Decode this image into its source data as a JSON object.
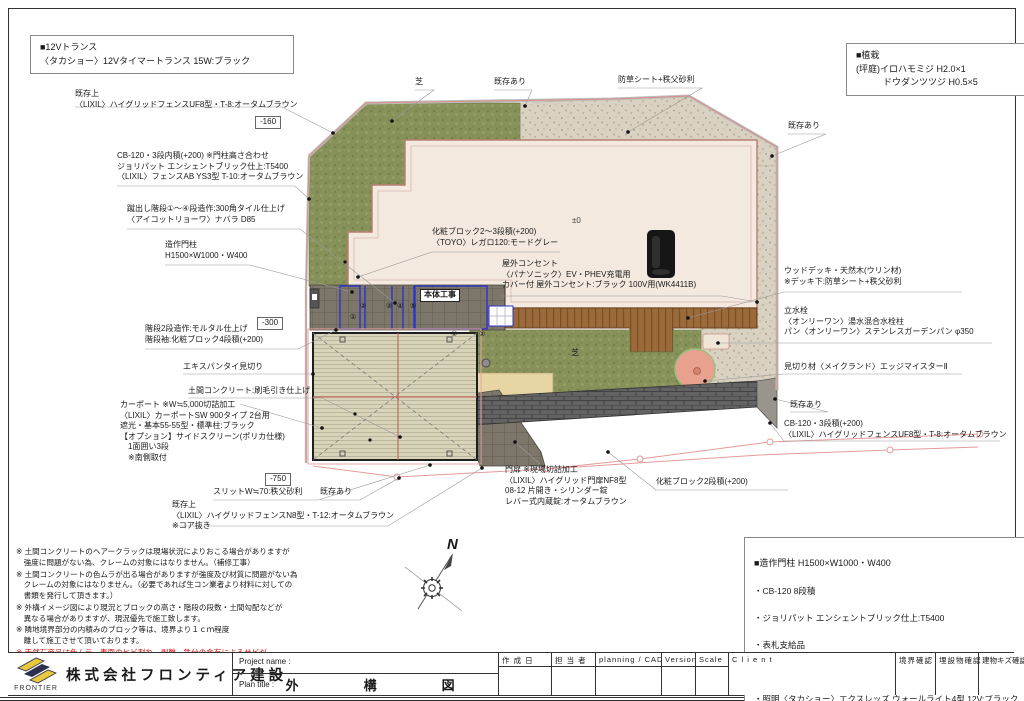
{
  "colors": {
    "boundary_pink": "#e59a9a",
    "lawn_green": "#87925a",
    "gravel_beige": "#d9d2c2",
    "house_fill": "#f3e9de",
    "deck_brown": "#9b6a3a",
    "blue_outline": "#2b35c8",
    "note_warning_red": "#cc1111",
    "logo_yellow": "#e6c93c",
    "logo_navy": "#2e2e4e"
  },
  "boxes": {
    "transformer": {
      "text": "■12Vトランス\n〈タカショー〉12Vタイマートランス 15W:ブラック"
    },
    "planting": {
      "text": "■植栽\n(坪庭)イロハモミジ H2.0×1\n　　　ドウダンツツジ H0.5×5"
    },
    "gate_pillar": {
      "title": "■造作門柱 H1500×W1000・W400",
      "items": [
        "・CB-120 8段積",
        "・ジョリパット エンシェントブリック仕上:T5400",
        "・表札支給品",
        "・ポスト〈LIXIL〉エクスポスト口金タイプ N-1型 1B-05:ブラック",
        "・照明〈タカショー〉エクスレッズ ウォールライト4型 12V:ブラック"
      ]
    }
  },
  "labels": {
    "fence_uf8_top": "既存上\n〈LIXIL〉ハイグリッドフェンスUF8型・T-8:オータムブラウン",
    "level_160": "-160",
    "cb120_fence_ab": "CB-120・3段内積(+200) ※門柱高さ合わせ\nジョリパット エンシェントブリック仕上:T5400\n〈LIXIL〉フェンスAB YS3型 T-10:オータムブラウン",
    "kedashi_stairs": "蹴出し階段①～④段造作:300角タイル仕上げ\n〈アイコットリョーワ〉ナバラ D85",
    "gate_pillar": "造作門柱\nH1500×W1000・W400",
    "level_300": "-300",
    "stairs2": "階段2段造作:モルタル仕上げ\n階段袖:化粧ブロック4段積(+200)",
    "expantie": "エキスパンタイ見切り",
    "doma_concrete": "土間コンクリート:刷毛引き仕上げ",
    "carport": "カーポート ※W≒5,000切詰加工\n〈LIXIL〉カーポートSW 900タイプ 2台用\n遮光・基本55-55型・標準柱:ブラック\n【オプション】サイドスクリーン(ポリカ仕様)\n　1面囲い3段\n　※南側取付",
    "level_750": "-750",
    "slit": "スリットW≒70:秩父砂利",
    "existing_bl": "既存あり",
    "fence_n8": "既存上\n〈LIXIL〉ハイグリッドフェンスN8型・T-12:オータムブラウン\n※コア抜き",
    "shiba_top": "芝",
    "existing_top": "既存あり",
    "weed_sheet": "防草シート+秩父砂利",
    "existing_tr": "既存あり",
    "keshou_23": "化粧ブロック2～3段積(+200)\n〈TOYO〉レガロ120:モードグレー",
    "outlet": "屋外コンセント\n〈パナソニック〉EV・PHEV充電用\nカバー付 屋外コンセント:ブラック 100V用(WK4411B)",
    "pm0": "±0",
    "hontai": "本体工事",
    "shiba_mid": "芝",
    "wood_deck": "ウッドデッキ・天然木(ウリン材)\n※デッキ下:防草シート+秩父砂利",
    "water": "立水栓\n〈オンリーワン〉湯水混合水栓柱\nパン〈オンリーワン〉ステンレスガーデンパン φ350",
    "mikiri": "見切り材〈メイクランド〉エッジマイスターⅡ",
    "existing_r": "既存あり",
    "cb120_r": "CB-120・3段積(+200)\n〈LIXIL〉ハイグリッドフェンスUF8型・T-8:オータムブラウン",
    "gate_door": "門扉 ※現場切詰加工\n〈LIXIL〉ハイグリッド門扉NF8型\n08-12 片開き・シリンダー錠\nレバー式内蔵錠:オータムブラウン",
    "keshou_2": "化粧ブロック2段積(+200)",
    "north": "N"
  },
  "step_numbers": [
    "①",
    "②",
    "③",
    "④",
    "⑤"
  ],
  "step_numbers_lower": [
    "①",
    "②"
  ],
  "notes": [
    {
      "text": "※ 土間コンクリートのヘアークラックは現場状況によりおこる場合がありますが\n　強度に問題がない為、クレームの対象にはなりません。（補修工事）"
    },
    {
      "text": "※ 土間コンクリートの色ムラが出る場合がありますが強度及び材質に問題がない為\n　クレームの対象にはなりません。（必要であれば生コン業者より材料に対しての\n　書類を発行して頂きます。）"
    },
    {
      "text": "※ 外構イメージ図により現況とブロックの高さ・階段の段数・土間勾配などが\n　異なる場合がありますが、現況優先で施工致します。"
    },
    {
      "text": "※ 隣地境界部分の内積みのブロック等は、境界より１ｃｍ程度\n　離して施工させて頂いております。"
    },
    {
      "text": "※ 天然石商品は色ムラ、表面のヒビ割れ、剥離、鉄分の含有によるサビが\n　発生する場合があります。天然石の性質になりますのでご理解ください。"
    }
  ],
  "title_block": {
    "company": "株式会社フロンティア建設",
    "logo": "FRONTIER",
    "project_name_label": "Project name :",
    "plan_title_label": "Plan title :",
    "plan_title": "外　構　図",
    "cols": [
      "作 成 日",
      "担 当 者",
      "planning / CAD",
      "Version",
      "Scale",
      "C l i e n t",
      "境界確認",
      "埋設物確認",
      "建物キズ確認"
    ]
  }
}
